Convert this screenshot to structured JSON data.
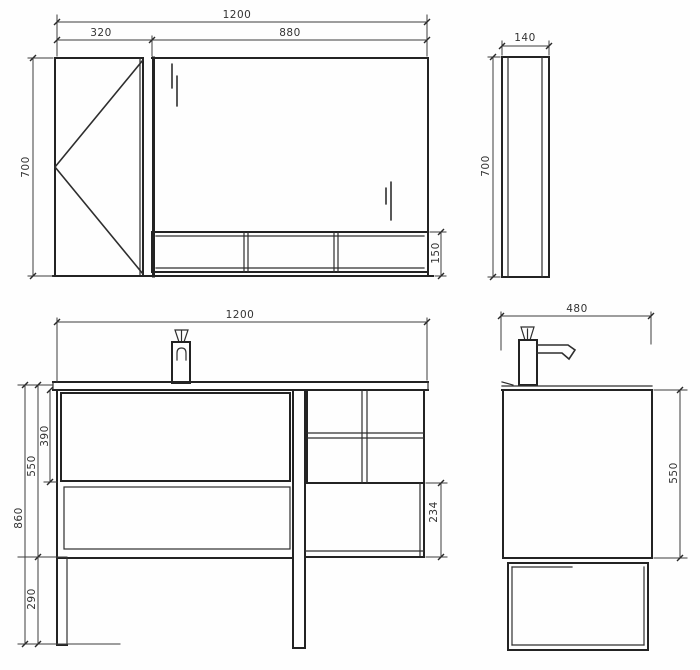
{
  "drawing": {
    "colors": {
      "background": "#fefefe",
      "object_line": "#232323",
      "dimension_line": "#3c3c3c",
      "text": "#333333"
    },
    "views": {
      "mirror_front": {
        "dims": {
          "total_width": "1200",
          "door_width": "320",
          "mirror_width": "880",
          "height": "700",
          "shelf_height": "150"
        }
      },
      "mirror_side": {
        "dims": {
          "depth": "140",
          "height": "700"
        }
      },
      "vanity_front": {
        "dims": {
          "width": "1200",
          "drawer_height": "390",
          "body_height": "550",
          "total_height": "860",
          "leg_height": "290",
          "open_shelf_height": "234"
        }
      },
      "vanity_side": {
        "dims": {
          "depth": "480",
          "height": "550"
        }
      }
    }
  }
}
